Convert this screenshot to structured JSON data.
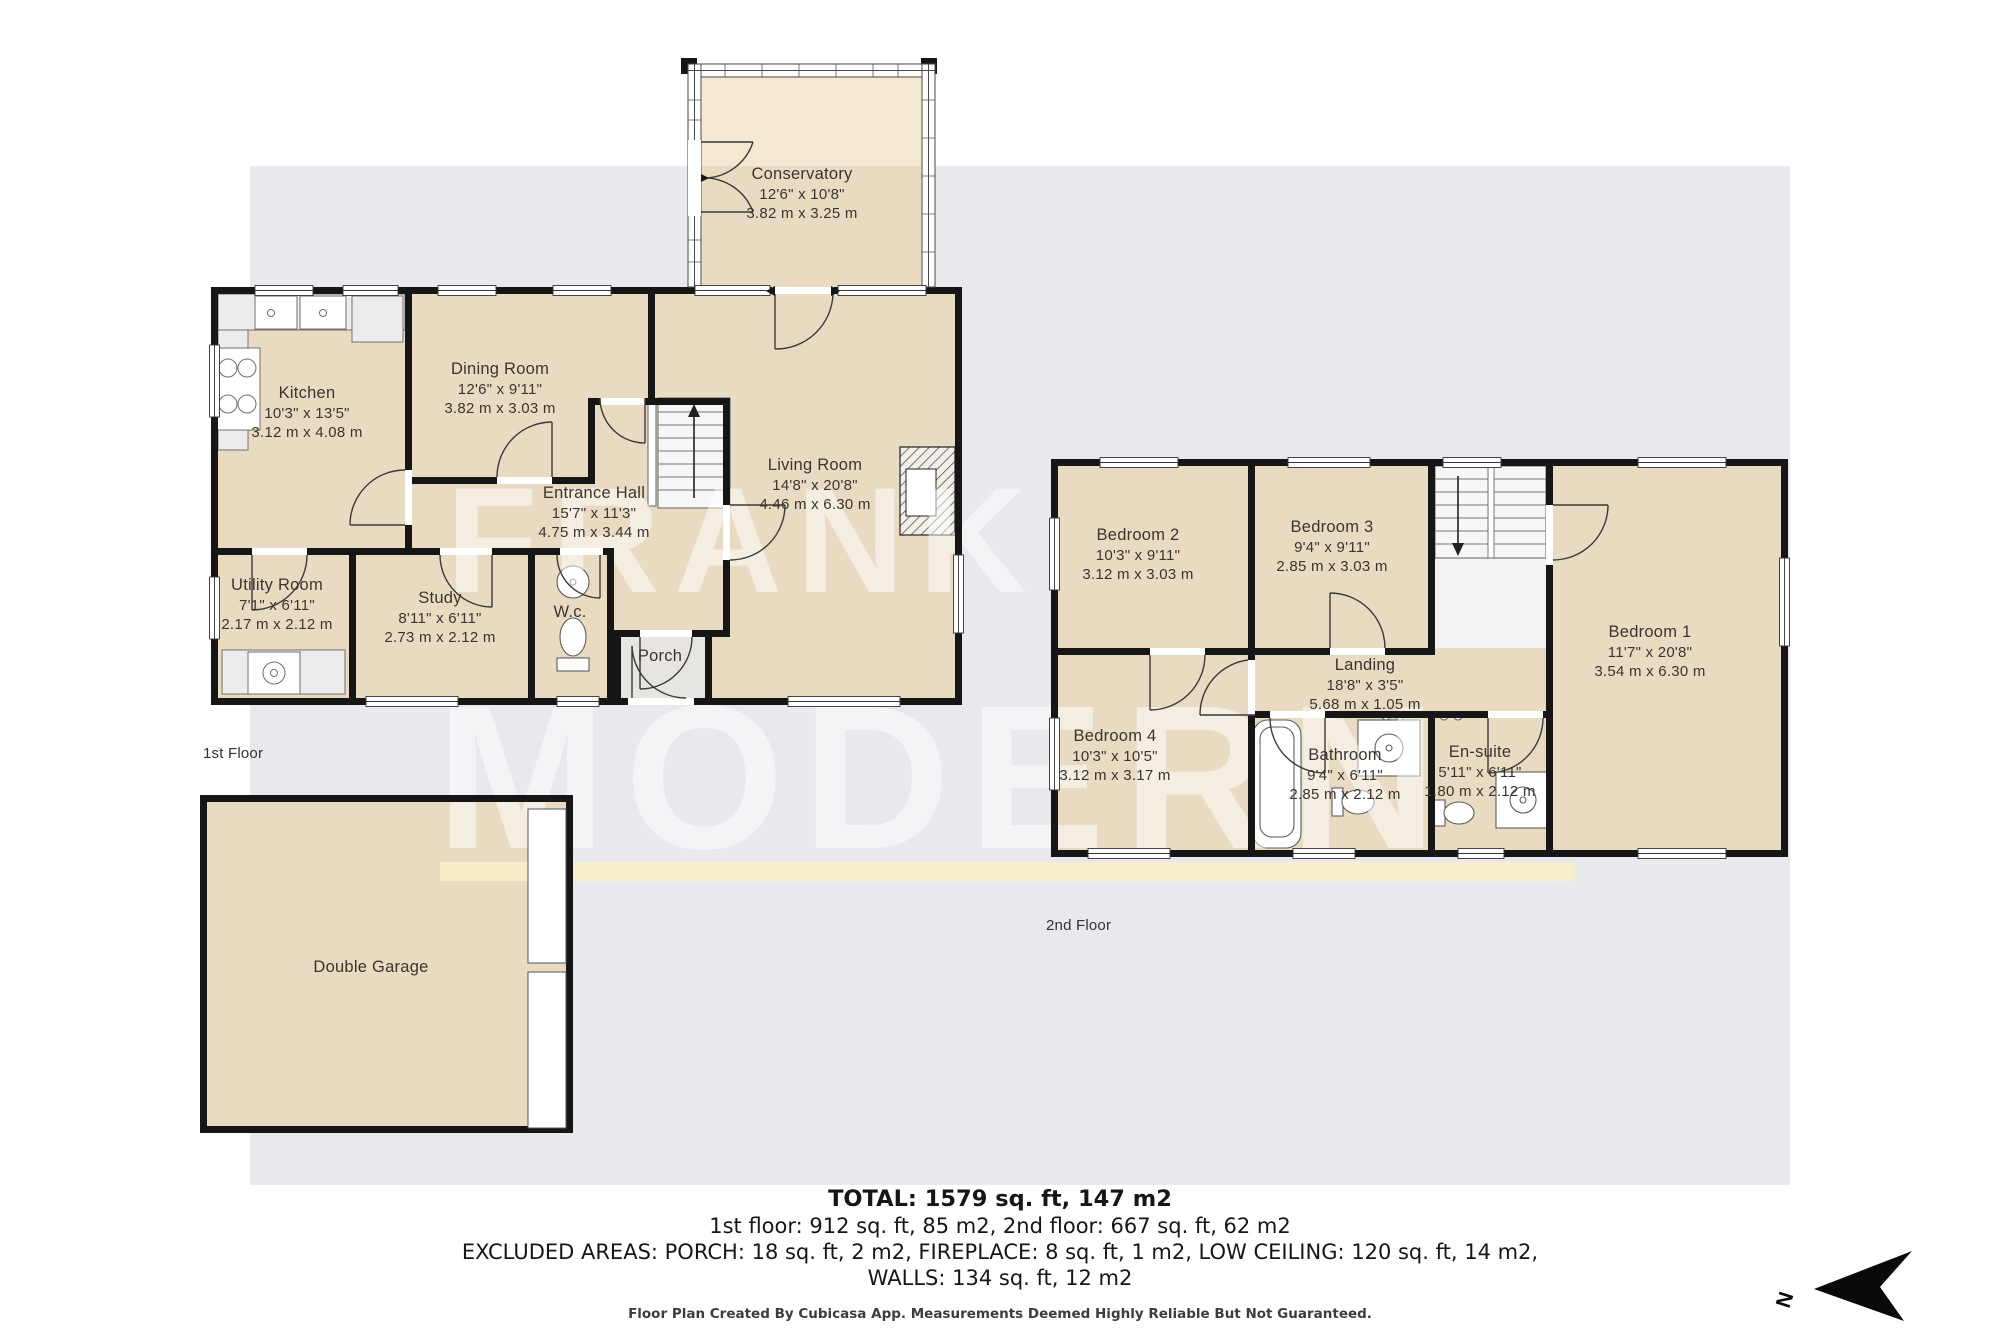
{
  "watermark": {
    "line1": "FRANK",
    "line2": "MODERN"
  },
  "floor_labels": {
    "first": "1st Floor",
    "second": "2nd Floor"
  },
  "rooms": {
    "conservatory": {
      "name": "Conservatory",
      "imperial": "12'6\" x 10'8\"",
      "metric": "3.82 m x 3.25 m"
    },
    "kitchen": {
      "name": "Kitchen",
      "imperial": "10'3\" x 13'5\"",
      "metric": "3.12 m x 4.08 m"
    },
    "dining": {
      "name": "Dining Room",
      "imperial": "12'6\" x 9'11\"",
      "metric": "3.82 m x 3.03 m"
    },
    "living": {
      "name": "Living Room",
      "imperial": "14'8\" x 20'8\"",
      "metric": "4.46 m x 6.30 m"
    },
    "hall": {
      "name": "Entrance Hall",
      "imperial": "15'7\" x 11'3\"",
      "metric": "4.75 m x 3.44 m"
    },
    "utility": {
      "name": "Utility Room",
      "imperial": "7'1\" x 6'11\"",
      "metric": "2.17 m x 2.12 m"
    },
    "study": {
      "name": "Study",
      "imperial": "8'11\" x 6'11\"",
      "metric": "2.73 m x 2.12 m"
    },
    "wc": {
      "name": "W.c."
    },
    "porch": {
      "name": "Porch"
    },
    "garage": {
      "name": "Double Garage"
    },
    "bedroom1": {
      "name": "Bedroom 1",
      "imperial": "11'7\" x 20'8\"",
      "metric": "3.54 m x 6.30 m"
    },
    "bedroom2": {
      "name": "Bedroom 2",
      "imperial": "10'3\" x 9'11\"",
      "metric": "3.12 m x 3.03 m"
    },
    "bedroom3": {
      "name": "Bedroom 3",
      "imperial": "9'4\" x 9'11\"",
      "metric": "2.85 m x 3.03 m"
    },
    "bedroom4": {
      "name": "Bedroom 4",
      "imperial": "10'3\" x 10'5\"",
      "metric": "3.12 m x 3.17 m"
    },
    "landing": {
      "name": "Landing",
      "imperial": "18'8\" x 3'5\"",
      "metric": "5.68 m x 1.05 m"
    },
    "bathroom": {
      "name": "Bathroom",
      "imperial": "9'4\" x 6'11\"",
      "metric": "2.85 m x 2.12 m"
    },
    "ensuite": {
      "name": "En-suite",
      "imperial": "5'11\" x 6'11\"",
      "metric": "1.80 m x 2.12 m"
    }
  },
  "summary": {
    "total": "TOTAL: 1579 sq. ft, 147 m2",
    "floors": "1st floor: 912 sq. ft, 85 m2, 2nd floor: 667 sq. ft, 62 m2",
    "excluded": "EXCLUDED AREAS: PORCH: 18 sq. ft, 2 m2, FIREPLACE: 8 sq. ft, 1 m2, LOW CEILING: 120 sq. ft, 14 m2,",
    "walls": "WALLS: 134 sq. ft, 12 m2"
  },
  "footer": "Floor Plan Created By Cubicasa App. Measurements Deemed Highly Reliable But Not Guaranteed.",
  "compass": {
    "letter": "N"
  },
  "colors": {
    "backdrop": "#e7e9ec",
    "room_fill": "#e8dbc2",
    "room_fill_light": "#f6e9d2",
    "wall": "#161616",
    "stripe": "#f9efc9",
    "watermark": "rgba(255,255,255,0.5)"
  }
}
